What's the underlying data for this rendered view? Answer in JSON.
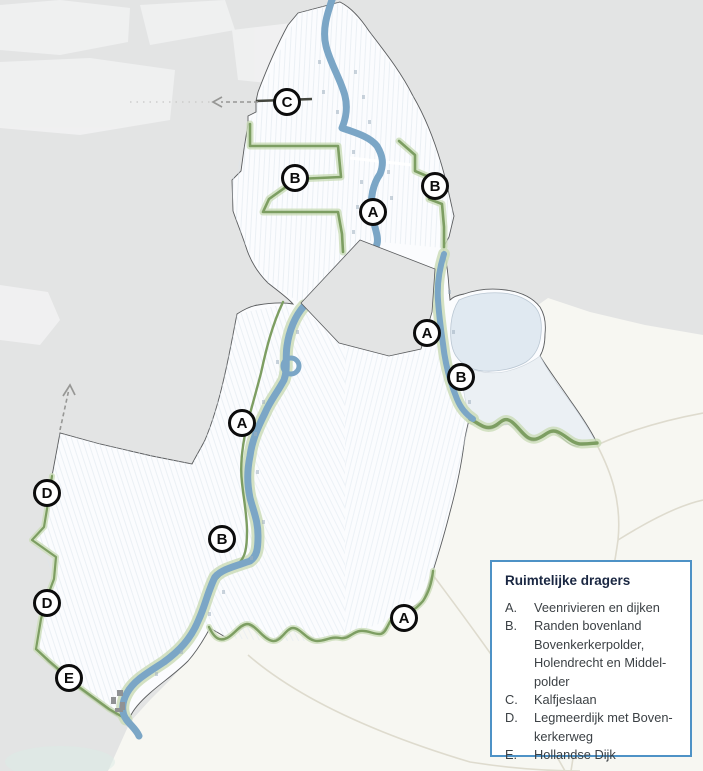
{
  "colors": {
    "background": "#e3e4e4",
    "outside_area": "#f7f7f2",
    "area_fill": "#fbfcfe",
    "river": "#7ba6c6",
    "green_edge": "#7d9e62",
    "green_halo": "#cbdcb8",
    "boundary": "#5b5d5f",
    "lake_fill": "#e0e9f1",
    "marker_ring": "#0c0c0c",
    "arrow": "#979795",
    "legend_border": "#4e92c6",
    "legend_title": "#1a2742",
    "legend_text": "#3c4145"
  },
  "map": {
    "markers": [
      {
        "letter": "C"
      },
      {
        "letter": "B"
      },
      {
        "letter": "A"
      },
      {
        "letter": "B"
      },
      {
        "letter": "A"
      },
      {
        "letter": "B"
      },
      {
        "letter": "A"
      },
      {
        "letter": "D"
      },
      {
        "letter": "B"
      },
      {
        "letter": "D"
      },
      {
        "letter": "A"
      },
      {
        "letter": "E"
      }
    ]
  },
  "legend": {
    "title": "Ruimtelijke dragers",
    "items": [
      {
        "letter": "A.",
        "label": "Veenrivieren en dijken"
      },
      {
        "letter": "B.",
        "label": "Randen bovenland\nBovenkerkerpolder,\nHolendrecht en Middel-\npolder"
      },
      {
        "letter": "C.",
        "label": "Kalfjeslaan"
      },
      {
        "letter": "D.",
        "label": "Legmeerdijk met Boven-\nkerkerweg"
      },
      {
        "letter": "E.",
        "label": "Hollandse Dijk"
      }
    ]
  }
}
